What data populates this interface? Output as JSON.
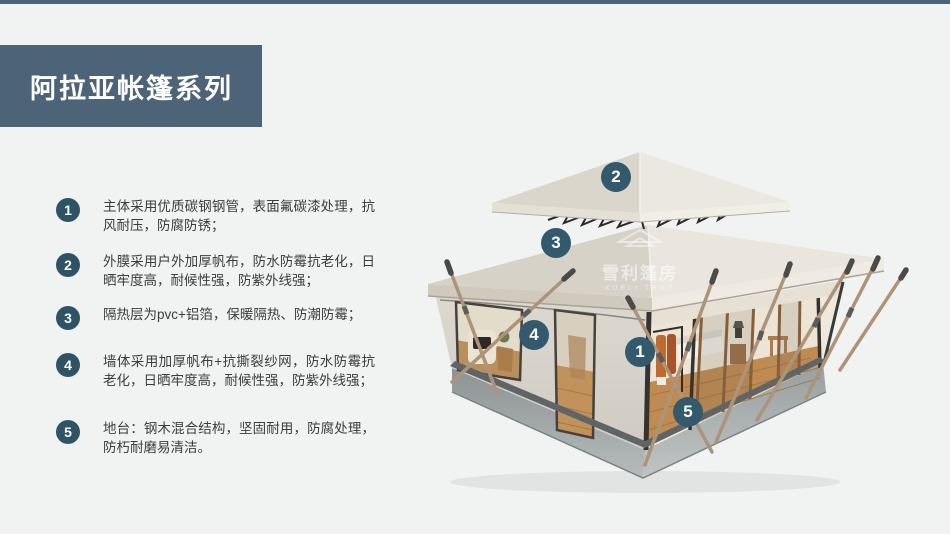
{
  "page": {
    "background": "#f1f2f2",
    "accent_strip": "#4c6378"
  },
  "header": {
    "title": "阿拉亚帐篷系列",
    "box_color": "#4d6478",
    "text_color": "#ffffff"
  },
  "features": {
    "badge_color": "#2d5364",
    "items": [
      {
        "num": "1",
        "text": "主体采用优质碳钢钢管，表面氟碳漆处理，抗风耐压，防腐防锈；"
      },
      {
        "num": "2",
        "text": "外膜采用户外加厚帆布，防水防霉抗老化，日晒牢度高，耐候性强，防紫外线强；"
      },
      {
        "num": "3",
        "text": "隔热层为pvc+铝箔，保暖隔热、防潮防霉；"
      },
      {
        "num": "4",
        "text": "墙体采用加厚帆布+抗撕裂纱网，防水防霉抗老化，日晒牢度高，耐候性强，防紫外线强；"
      },
      {
        "num": "5",
        "text": "地台：钢木混合结构，坚固耐用，防腐处理，防朽耐磨易清洁。"
      }
    ]
  },
  "illustration": {
    "description": "双层尖顶帐篷三维效果图",
    "marker_color": "#33596c",
    "markers": [
      {
        "num": "1"
      },
      {
        "num": "2"
      },
      {
        "num": "3"
      },
      {
        "num": "4"
      },
      {
        "num": "5"
      }
    ],
    "watermark": {
      "cn": "雪利篷房",
      "en": "XUELI TENT"
    }
  }
}
